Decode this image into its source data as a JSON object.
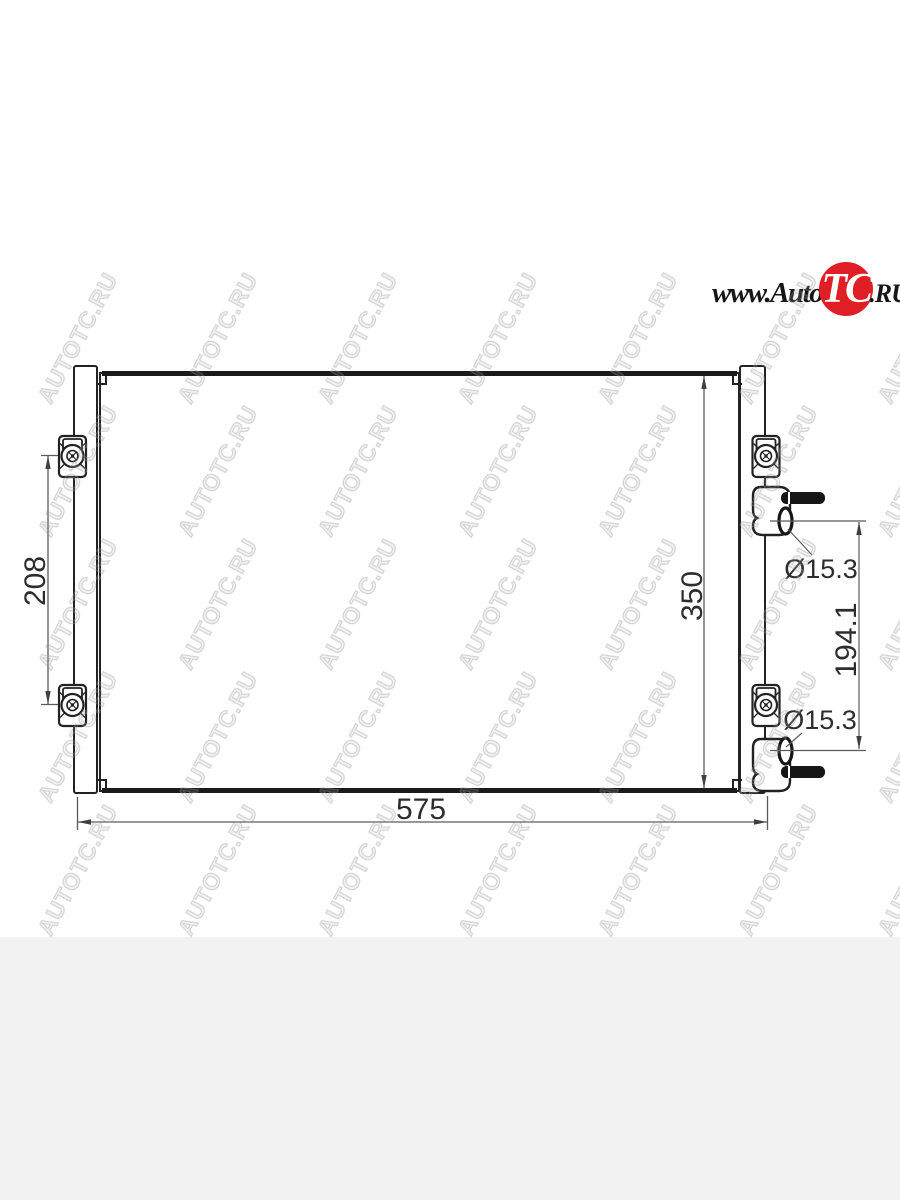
{
  "page": {
    "background_color": "#ffffff",
    "bottom_band_color": "#f2f2f2"
  },
  "logo": {
    "prefix": "www.Auto",
    "emblem": "TC",
    "suffix": ".RU",
    "circle_color": "#e01e25",
    "text_color": "#161616",
    "emblem_text_color": "#ffffff"
  },
  "watermark": {
    "text": "AUTOTC.RU"
  },
  "diagram": {
    "subject": "air-conditioning-condenser-outline-drawing",
    "line_color": "#222222",
    "dimension_line_color": "#5a5a5a",
    "dimensions": {
      "width": "575",
      "height": "350",
      "bracket_spacing": "208",
      "port_spacing": "194.1",
      "port_diameter_upper": "Ø15.3",
      "port_diameter_lower": "Ø15.3"
    }
  }
}
